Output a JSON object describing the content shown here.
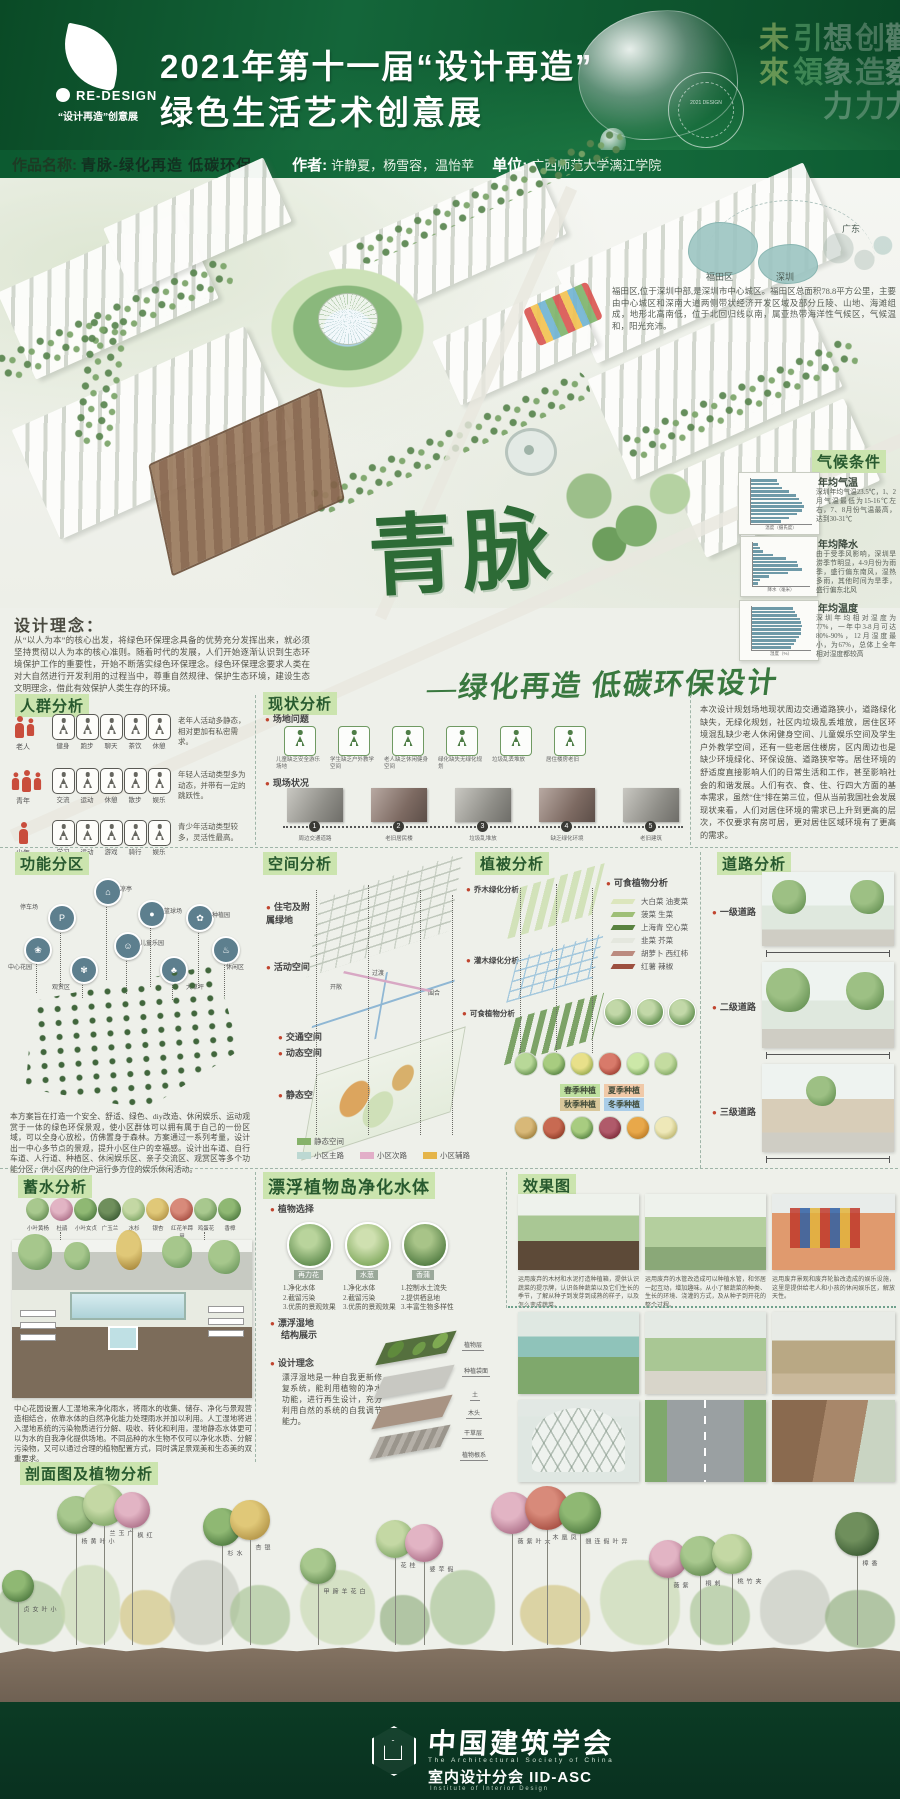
{
  "colors": {
    "header_green": "#0f5c30",
    "footer_green": "#0b3b24",
    "heading_chip_bg": "#cbe4ae",
    "heading_text": "#27592e",
    "accent_red": "#c0452f",
    "bar_color": "#6f9aa8"
  },
  "header": {
    "brand": "RE-DESIGN",
    "brand_tagline": "“设计再造”创意展",
    "title_line1": "2021年第十一届“设计再造”",
    "title_line2": "绿色生活艺术创意展",
    "watermarks": [
      "未來",
      "引領",
      "想象力",
      "创造力",
      "觀察力"
    ],
    "seal_text": "2021 DESIGN"
  },
  "info_bar": {
    "work_label": "作品名称:",
    "work_name": "青脉-绿化再造 低碳环保",
    "author_label": "作者:",
    "authors": "许静夏，杨雪容，温怡苹",
    "unit_label": "单位:",
    "unit": "广西师范大学漓江学院"
  },
  "site_map": {
    "province": "广东",
    "district": "福田区",
    "city": "深圳",
    "description": "福田区,位于深圳中部,是深圳市中心城区。福田区总面积78.8平方公里，主要由中心城区和深南大道两侧带状经济开发区域及部分丘陵、山地、海滩组成，地形北高南低，位于北回归线以南，属亚热带海洋性气候区，气候温和，阳光充沛。"
  },
  "climate": {
    "heading": "气候条件",
    "sections": [
      {
        "title": "年均气温",
        "text": "深圳年均气温23.5℃，1、2月气温最低为15-16℃左右，7、8月份气温最高，达到30-31℃"
      },
      {
        "title": "年均降水",
        "text": "由于受季风影响，深圳旱涝季节明显，4-9月份为雨季，盛行偏东南风，湿热多雨，其他时间为旱季，盛行偏东北风"
      },
      {
        "title": "年均温度",
        "text": "深圳年均相对湿度为77%，一年中3-8月可达80%-90%，12月湿度最小，为67%，总体上全年相对湿度都较高"
      }
    ]
  },
  "chart_data": [
    {
      "type": "bar",
      "orientation": "horizontal",
      "title": "年均气温",
      "categories": [
        "1月",
        "2月",
        "3月",
        "4月",
        "5月",
        "6月",
        "7月",
        "8月",
        "9月",
        "10月",
        "11月",
        "12月"
      ],
      "values": [
        15,
        16,
        18,
        22,
        26,
        28,
        30,
        31,
        30,
        27,
        22,
        17
      ],
      "xlabel": "温度（摄氏度）",
      "ylabel": "月份",
      "xlim": [
        0,
        35
      ],
      "legend_position": "none",
      "grid": false
    },
    {
      "type": "bar",
      "orientation": "horizontal",
      "title": "年均降水",
      "categories": [
        "1月",
        "2月",
        "3月",
        "4月",
        "5月",
        "6月",
        "7月",
        "8月",
        "9月",
        "10月",
        "11月",
        "12月"
      ],
      "values": [
        30,
        45,
        65,
        140,
        230,
        310,
        320,
        350,
        250,
        110,
        40,
        28
      ],
      "xlabel": "降水（毫米）",
      "ylabel": "月份",
      "xlim": [
        0,
        400
      ],
      "legend_position": "none",
      "grid": false
    },
    {
      "type": "bar",
      "orientation": "horizontal",
      "title": "年均湿度",
      "categories": [
        "1月",
        "2月",
        "3月",
        "4月",
        "5月",
        "6月",
        "7月",
        "8月",
        "9月",
        "10月",
        "11月",
        "12月"
      ],
      "values": [
        70,
        74,
        78,
        82,
        84,
        86,
        85,
        84,
        81,
        76,
        72,
        67
      ],
      "xlabel": "湿度（%）",
      "ylabel": "月份",
      "xlim": [
        0,
        100
      ],
      "legend_position": "none",
      "grid": false
    }
  ],
  "hero": {
    "calligraphy": "青脉",
    "subtitle": "—绿化再造 低碳环保设计"
  },
  "design_concept": {
    "heading": "设计理念：",
    "body": "从“以人为本”的核心出发，将绿色环保理念具备的优势充分发挥出来，就必须坚持贯彻以人为本的核心准则。随着时代的发展，人们开始逐渐认识到生态环境保护工作的重要性，开始不断落实绿色环保理念。绿色环保理念要求人类在对大自然进行开发利用的过程当中，尊重自然规律、保护生态环境，建设生态文明理念，借此有效保护人类生存的环境。"
  },
  "crowd_analysis": {
    "heading": "人群分析",
    "rows": [
      {
        "group": "老人",
        "activities": [
          "健身",
          "跑步",
          "聊天",
          "茶饮",
          "休憩"
        ],
        "note": "老年人活动多静态，相对更加有私密需求。"
      },
      {
        "group": "青年",
        "activities": [
          "交流",
          "运动",
          "休憩",
          "散步",
          "娱乐"
        ],
        "note": "年轻人活动类型多为动态，并带有一定的跳跃性。"
      },
      {
        "group": "少年",
        "activities": [
          "学习",
          "运动",
          "游戏",
          "骑行",
          "娱乐"
        ],
        "note": "青少年活动类型较多，灵活性最高。"
      }
    ]
  },
  "status": {
    "heading": "现状分析",
    "issues_label": "场地问题",
    "issues": [
      "儿童缺乏安全游乐场地",
      "学生缺乏户外教学空间",
      "老人缺乏休闲健身空间",
      "绿化缺失无绿化规划",
      "垃圾乱丢堆放",
      "居住楼房老旧"
    ],
    "photos_label": "现场状况",
    "photos": [
      {
        "num": "1",
        "label": "周边交通道路"
      },
      {
        "num": "2",
        "label": "老旧居民楼"
      },
      {
        "num": "3",
        "label": "垃圾乱堆放"
      },
      {
        "num": "4",
        "label": "缺乏绿化环境"
      },
      {
        "num": "5",
        "label": "老旧建筑"
      }
    ],
    "paragraph": "本次设计规划场地现状周边交通道路狭小，道路绿化缺失，无绿化规划，社区内垃圾乱丢堆放，居住区环境混乱缺少老人休闲健身空间、儿童娱乐空间及学生户外教学空间，还有一些老居住楼房，区内周边也是缺少环境绿化、环保设施、道路狭窄等。居住环境的舒适度直接影响人们的日常生活和工作，甚至影响社会的和谐发展。人们有衣、食、住、行四大方面的基本需求，虽然“住”排在第三位，但从当前我国社会发展现状来看，人们对居住环境的需求已上升到更高的层次，不仅要求有房可居，更对居住区域环境有了更高的需求。"
  },
  "function_zoning": {
    "heading": "功能分区",
    "nodes": [
      "凉亭",
      "停车场",
      "篮球场",
      "种植园",
      "中心花园",
      "儿童乐园",
      "休闲区",
      "观赏区",
      "大草坪"
    ],
    "paragraph": "本方案旨在打造一个安全、舒适、绿色、diy改造、休闲娱乐、运动观赏于一体的绿色环保景观，使小区群体可以拥有属于自己的一份区域，可以全身心放松，仿佛置身于森林。方案通过一系列考量，设计出一中心多节点的景观，提升小区住户的幸福感。设计出车道、自行车道、人行道、种植区、休闲娱乐区、亲子交流区、观赏区等多个功能分区，供小区内的住户运行多方位的娱乐休闲活动。"
  },
  "space": {
    "heading": "空间分析",
    "layers": [
      "住宅及附属绿地",
      "活动空间",
      "交通空间",
      "动态空间",
      "静态空间"
    ],
    "annotations": [
      "开敞",
      "过渡",
      "围合"
    ],
    "legend": [
      {
        "label": "静态空间",
        "color": "#86b26a"
      },
      {
        "label": "小区主路",
        "color": "#bcd8d2"
      },
      {
        "label": "小区次路",
        "color": "#e2aec8"
      },
      {
        "label": "小区辅路",
        "color": "#e5b54a"
      }
    ]
  },
  "vegetation": {
    "heading": "植被分析",
    "layer_bullets": [
      "乔木绿化分析",
      "灌木绿化分析",
      "可食植物分析"
    ],
    "edible_title": "可食植物分析",
    "edible_legend": [
      "大白菜 油麦菜",
      "菠菜 生菜",
      "上海青 空心菜",
      "韭菜 芥菜",
      "胡萝卜 西红柿",
      "红薯 辣椒"
    ],
    "seasons": [
      "春季种植",
      "夏季种植",
      "秋季种植",
      "冬季种植"
    ]
  },
  "roads": {
    "heading": "道路分析",
    "levels": [
      "一级道路",
      "二级道路",
      "三级道路"
    ]
  },
  "water": {
    "heading": "蓄水分析",
    "trees": [
      "小叶黄杨",
      "杜鹃",
      "小叶女贞",
      "广玉兰",
      "水杉",
      "银杏",
      "红花羊蹄甲",
      "鸡蛋花",
      "香樟"
    ],
    "paragraph": "中心花园设置人工湿地来净化雨水，将雨水的收集、储存、净化与景观营造相结合，依靠水体的自然净化能力处理雨水并加以利用。人工湿地将进入湿地系统的污染物质进行分解、吸收、转化和利用，湿地静态水体更可以为水的自我净化提供场地。不同品种的水生物不仅可以净化水质、分解污染物，又可以通过合理的植物配置方式，同时满足景观美和生态美的双重要求。"
  },
  "floating": {
    "heading": "漂浮植物岛净化水体",
    "select_label": "植物选择",
    "plants": [
      {
        "name": "再力花",
        "benefits": [
          "1.净化水体",
          "2.截留污染",
          "3.优质的景观效果"
        ]
      },
      {
        "name": "水葱",
        "benefits": [
          "1.净化水体",
          "2.截留污染",
          "3.优质的景观效果"
        ]
      },
      {
        "name": "香蒲",
        "benefits": [
          "1.控制水土流失",
          "2.提供栖息地",
          "3.丰富生物多样性"
        ]
      }
    ],
    "structure_label": "漂浮湿地",
    "structure_label2": "结构展示",
    "concept_label": "设计理念",
    "concept_text": "漂浮湿地是一种自我更新修复系统，能利用植物的净水功能，进行再生设计，充分利用自然的系统的自我调节能力。",
    "layers": [
      "植物层",
      "种植袋面",
      "土",
      "木头",
      "干草层",
      "植物根系"
    ]
  },
  "renderings": {
    "heading": "效果图",
    "captions": [
      "运用废弃的木材和水泥打造种植箱，提供认识蔬菜的提示牌，认识各种蔬菜以及它们生长的季节，了解从种子到发芽到成熟的样子，以及怎么变成蔬菜。",
      "运用废弃的水管改造成可以种植水管，和邻居一起互动，增加趣味。从小了解蔬菜的种类、生长的环境、浇灌的方式，及从种子到开花的整个过程。",
      "运用废弃景观和废弃轮胎改造成的娱乐设施，这里是提供给老人和小孩的休闲娱乐区，解放天性。"
    ]
  },
  "profile": {
    "heading": "剖面图及植物分析",
    "plants": [
      "小叶女贞",
      "小叶黄杨",
      "广玉兰",
      "红枫",
      "水杉",
      "银杏",
      "白花羊蹄甲",
      "桂花",
      "假苹婆",
      "大叶紫薇",
      "凤凰木",
      "异叶假连翘",
      "紫薇",
      "刺桐",
      "夹竹桃",
      "香樟"
    ]
  },
  "footer": {
    "org_cn": "中国建筑学会",
    "org_en": "The Architectural Society of China",
    "branch": "室内设计分会 IID-ASC",
    "branch_en": "Institute of Interior Design"
  }
}
